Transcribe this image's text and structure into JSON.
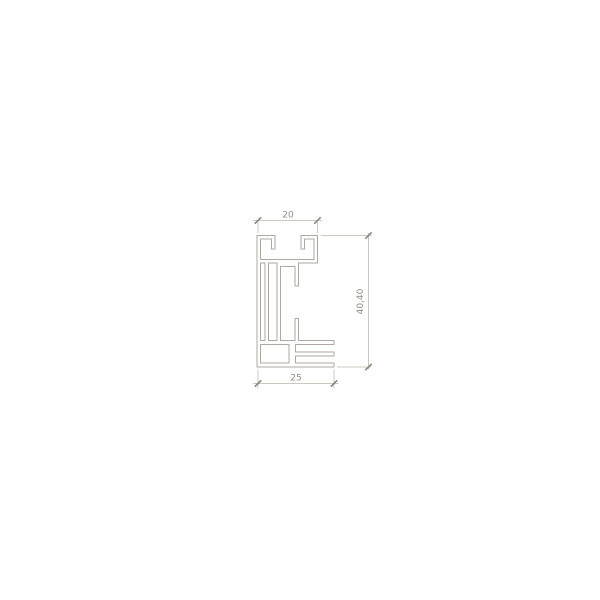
{
  "diagram": {
    "type": "technical-drawing",
    "subject": "aluminum-profile-cross-section",
    "background": "#ffffff",
    "canvas": {
      "width": 600,
      "height": 600
    },
    "colors": {
      "profile_stroke": "#ada9a0",
      "dim_stroke": "#cbc8c1",
      "tick_stroke": "#8a867e",
      "text": "#918d85"
    },
    "text_style": {
      "font_size": 9
    },
    "profile": {
      "outer_path": [
        [
          257,
          235.5
        ],
        [
          275,
          235.5
        ],
        [
          275,
          249
        ],
        [
          271.5,
          249
        ],
        [
          271.5,
          239
        ],
        [
          260.5,
          239
        ],
        [
          260.5,
          259.5
        ],
        [
          314,
          259.5
        ],
        [
          314,
          239
        ],
        [
          304.5,
          239
        ],
        [
          304.5,
          249
        ],
        [
          301,
          249
        ],
        [
          301,
          235.5
        ],
        [
          317.5,
          235.5
        ],
        [
          317.5,
          263
        ],
        [
          298.5,
          263
        ],
        [
          298.5,
          286
        ],
        [
          295,
          286
        ],
        [
          295,
          266.5
        ],
        [
          280.5,
          266.5
        ],
        [
          280.5,
          340.5
        ],
        [
          295,
          340.5
        ],
        [
          295,
          318.5
        ],
        [
          298.5,
          318.5
        ],
        [
          298.5,
          340.5
        ],
        [
          334,
          340.5
        ],
        [
          334,
          344.5
        ],
        [
          295.5,
          344.5
        ],
        [
          295.5,
          352
        ],
        [
          334,
          352
        ],
        [
          334,
          356
        ],
        [
          295.5,
          356
        ],
        [
          295.5,
          363
        ],
        [
          334,
          363
        ],
        [
          334,
          367
        ],
        [
          257,
          367
        ]
      ],
      "hollows": [
        {
          "name": "left-screw-channel",
          "path": [
            [
              260.5,
              263
            ],
            [
              265,
              263
            ],
            [
              265,
              340.5
            ],
            [
              260.5,
              340.5
            ]
          ]
        },
        {
          "name": "mid-left-chamber",
          "path": [
            [
              268.5,
              263
            ],
            [
              277,
              263
            ],
            [
              277,
              340.5
            ],
            [
              268.5,
              340.5
            ]
          ]
        },
        {
          "name": "bottom-left-chamber",
          "path": [
            [
              260.5,
              344.5
            ],
            [
              289,
              344.5
            ],
            [
              289,
              363
            ],
            [
              260.5,
              363
            ]
          ]
        }
      ]
    },
    "dimension_annotations": [
      {
        "id": "top-width",
        "label": "20",
        "orientation": "horizontal",
        "ext_lines": [
          {
            "x1": 258,
            "y1": 222,
            "x2": 258,
            "y2": 233
          },
          {
            "x1": 317.5,
            "y1": 222,
            "x2": 317.5,
            "y2": 233
          }
        ],
        "dim_line": {
          "x1": 253,
          "y1": 220.5,
          "x2": 322,
          "y2": 220.5
        },
        "ticks": [
          {
            "x": 258,
            "y": 220.5
          },
          {
            "x": 317.5,
            "y": 220.5
          }
        ],
        "label_pos": {
          "x": 288,
          "y": 217.5,
          "rotate": 0
        }
      },
      {
        "id": "right-height",
        "label": "40,40",
        "orientation": "vertical",
        "ext_lines": [
          {
            "x1": 321,
            "y1": 235.5,
            "x2": 371.5,
            "y2": 235.5
          },
          {
            "x1": 337,
            "y1": 367,
            "x2": 371.5,
            "y2": 367
          }
        ],
        "dim_line": {
          "x1": 368.5,
          "y1": 233,
          "x2": 368.5,
          "y2": 369.5
        },
        "ticks": [
          {
            "x": 368.5,
            "y": 235.5
          },
          {
            "x": 368.5,
            "y": 367
          }
        ],
        "label_pos": {
          "x": 363,
          "y": 301.5,
          "rotate": -90
        }
      },
      {
        "id": "bottom-width",
        "label": "25",
        "orientation": "horizontal",
        "ext_lines": [
          {
            "x1": 258,
            "y1": 369.5,
            "x2": 258,
            "y2": 388.5
          },
          {
            "x1": 334,
            "y1": 369.5,
            "x2": 334,
            "y2": 388.5
          }
        ],
        "dim_line": {
          "x1": 253,
          "y1": 383.5,
          "x2": 338.5,
          "y2": 383.5
        },
        "ticks": [
          {
            "x": 258,
            "y": 383.5
          },
          {
            "x": 334,
            "y": 383.5
          }
        ],
        "label_pos": {
          "x": 296,
          "y": 380.5,
          "rotate": 0
        }
      }
    ]
  }
}
